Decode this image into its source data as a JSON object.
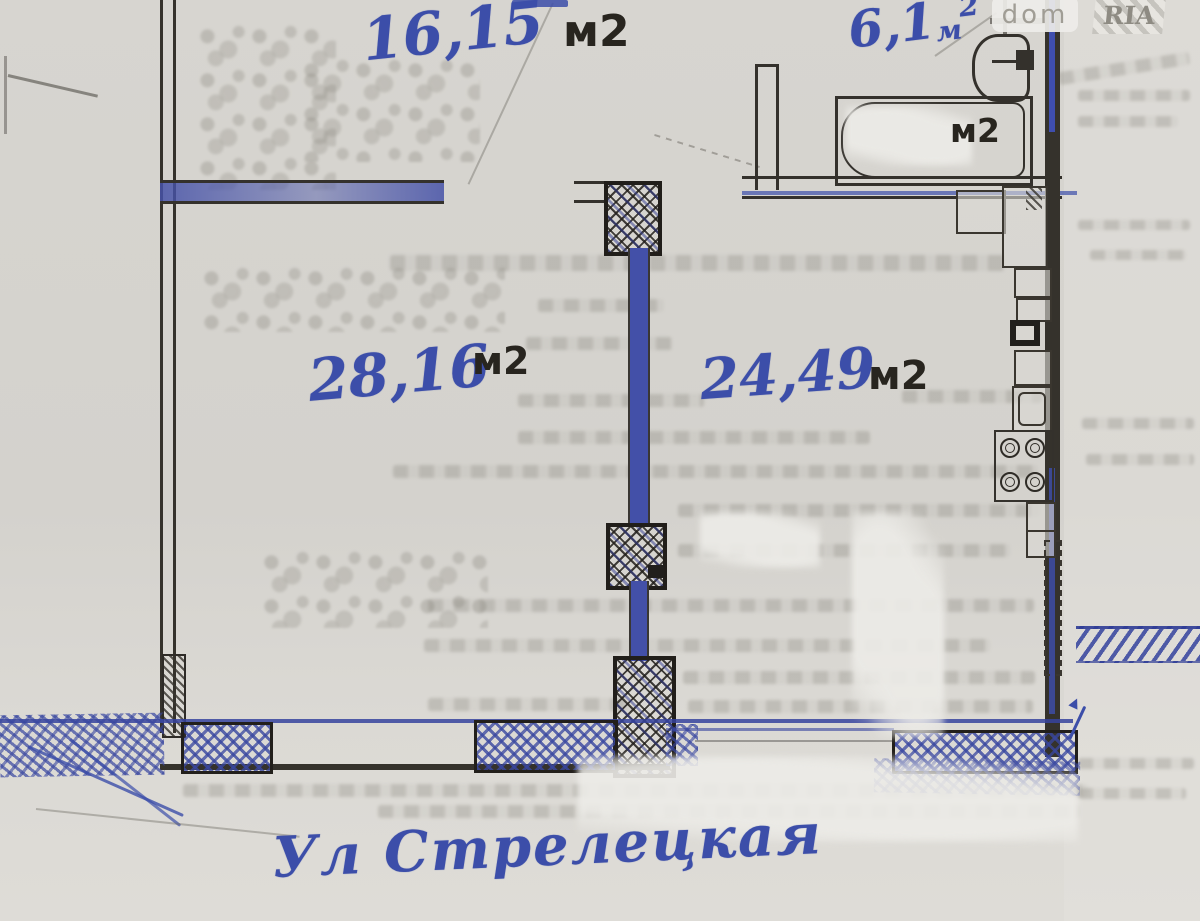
{
  "colors": {
    "pen": "#3c4ea9",
    "ink": "#28251f",
    "paper": "#d7d5d0"
  },
  "watermark": {
    "dom": "dom",
    "ria": "RIA"
  },
  "rooms": {
    "top": {
      "area": "16,15",
      "unit": "м2"
    },
    "living": {
      "area": "28,16",
      "unit": "м2"
    },
    "kitchen": {
      "area": "24,49",
      "unit": "м2"
    },
    "bath": {
      "area": "6,1",
      "unit": "м",
      "sup": "2"
    }
  },
  "bathtub": {
    "label": "м2"
  },
  "street": {
    "label": "Ул Стрелецкая"
  }
}
